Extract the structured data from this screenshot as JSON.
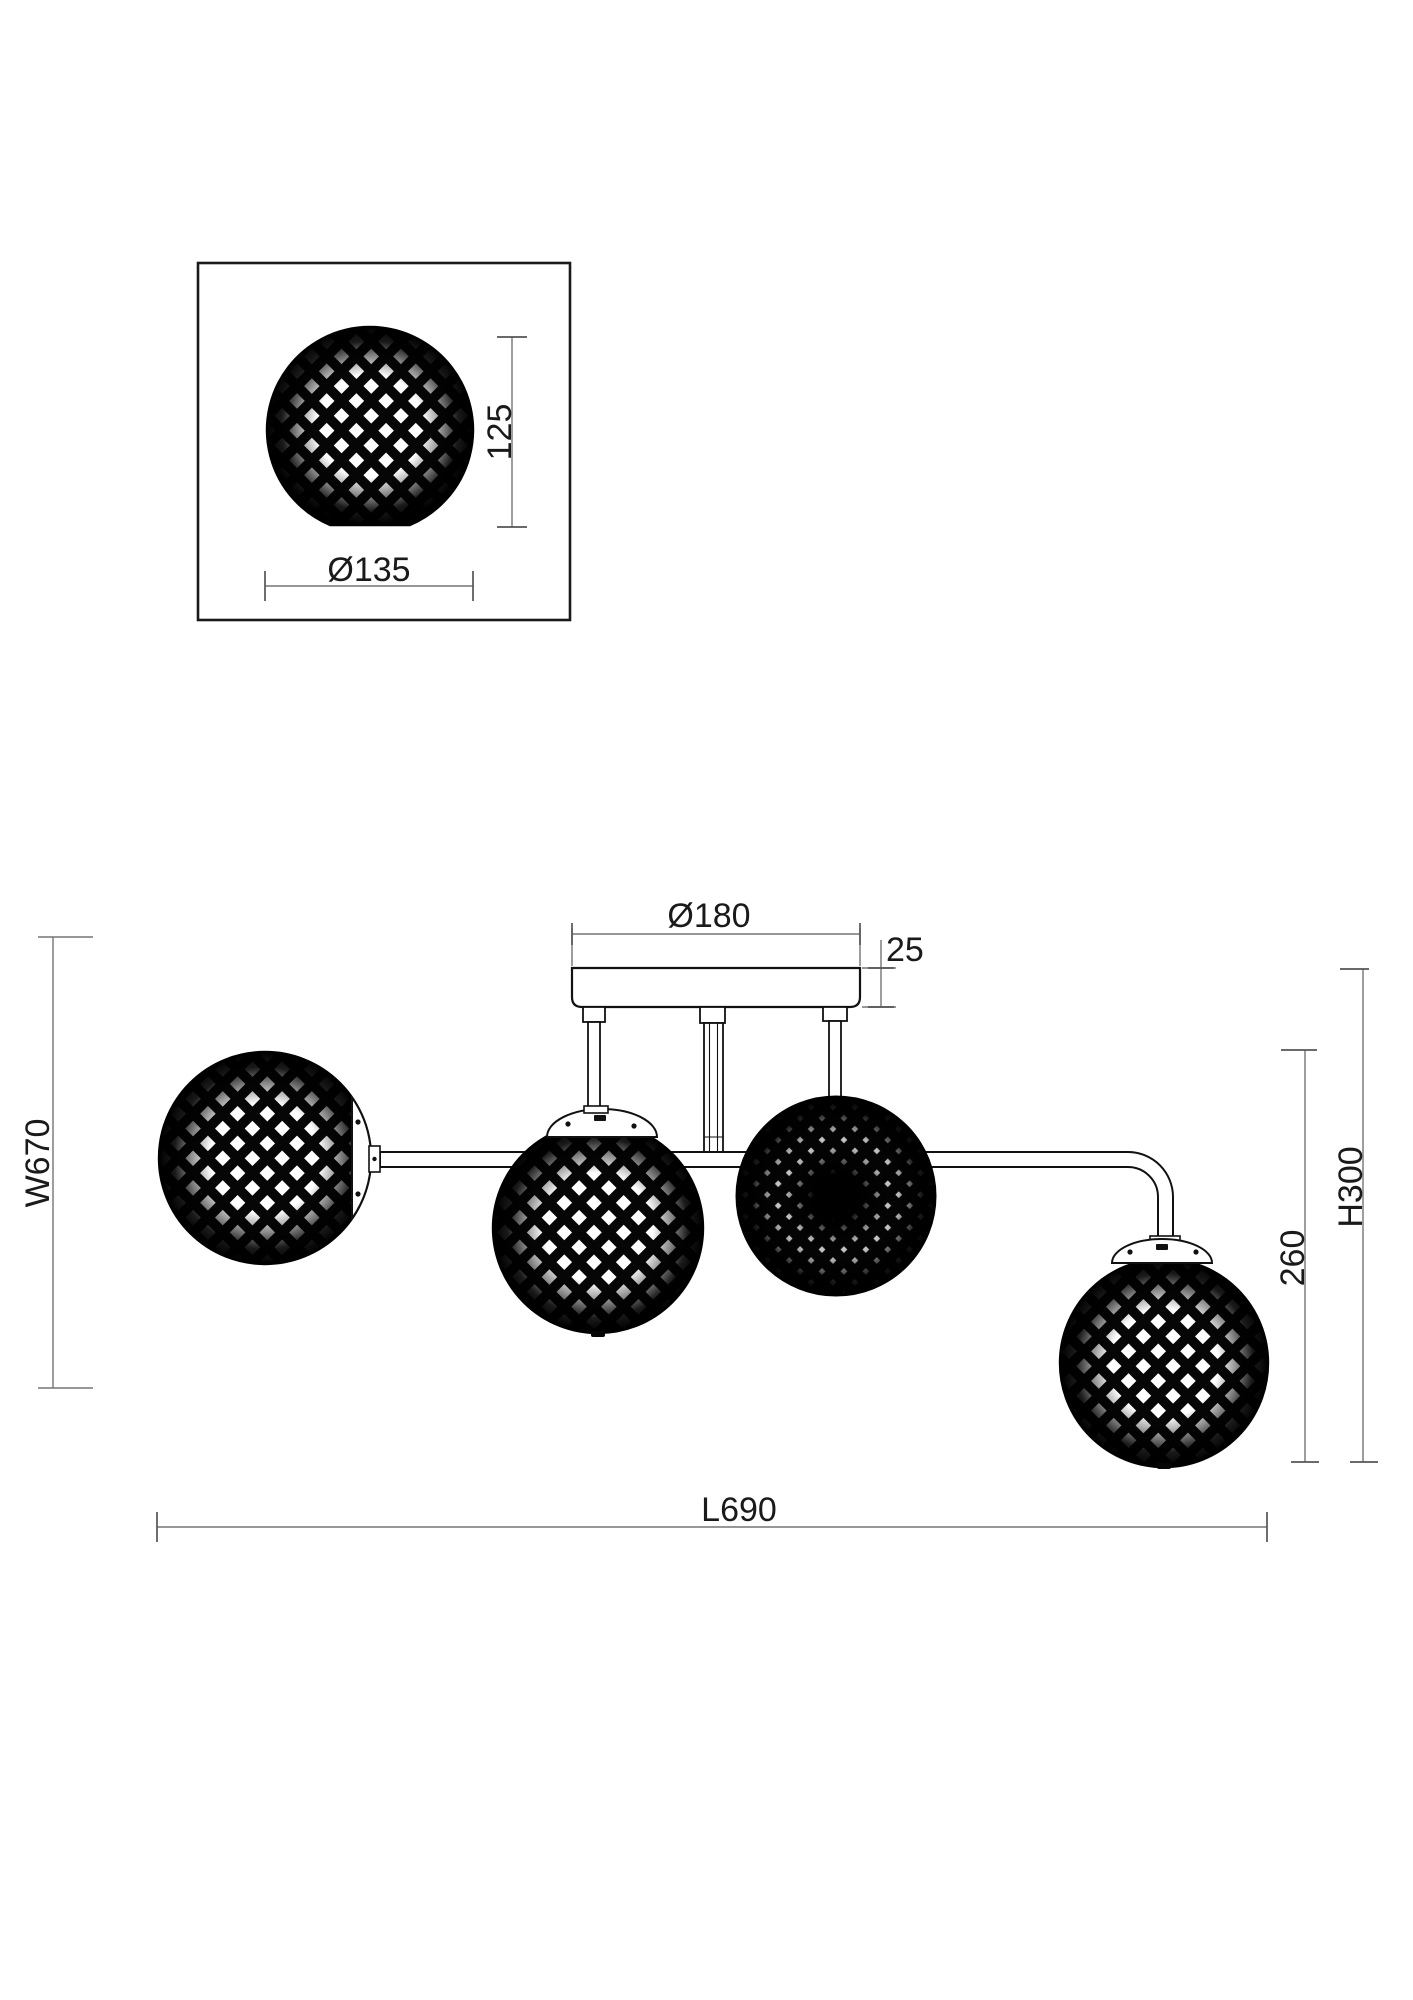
{
  "colors": {
    "drawing_line": "#111111",
    "dimension_line": "#757575",
    "text": "#1a1a1a",
    "background": "#ffffff"
  },
  "detail_view": {
    "shade_height": "125",
    "shade_diameter": "Ø135"
  },
  "main_view": {
    "canopy_diameter": "Ø180",
    "canopy_thickness": "25",
    "fixture_width": "W670",
    "fixture_length": "L690",
    "body_drop": "260",
    "fixture_height": "H300"
  }
}
